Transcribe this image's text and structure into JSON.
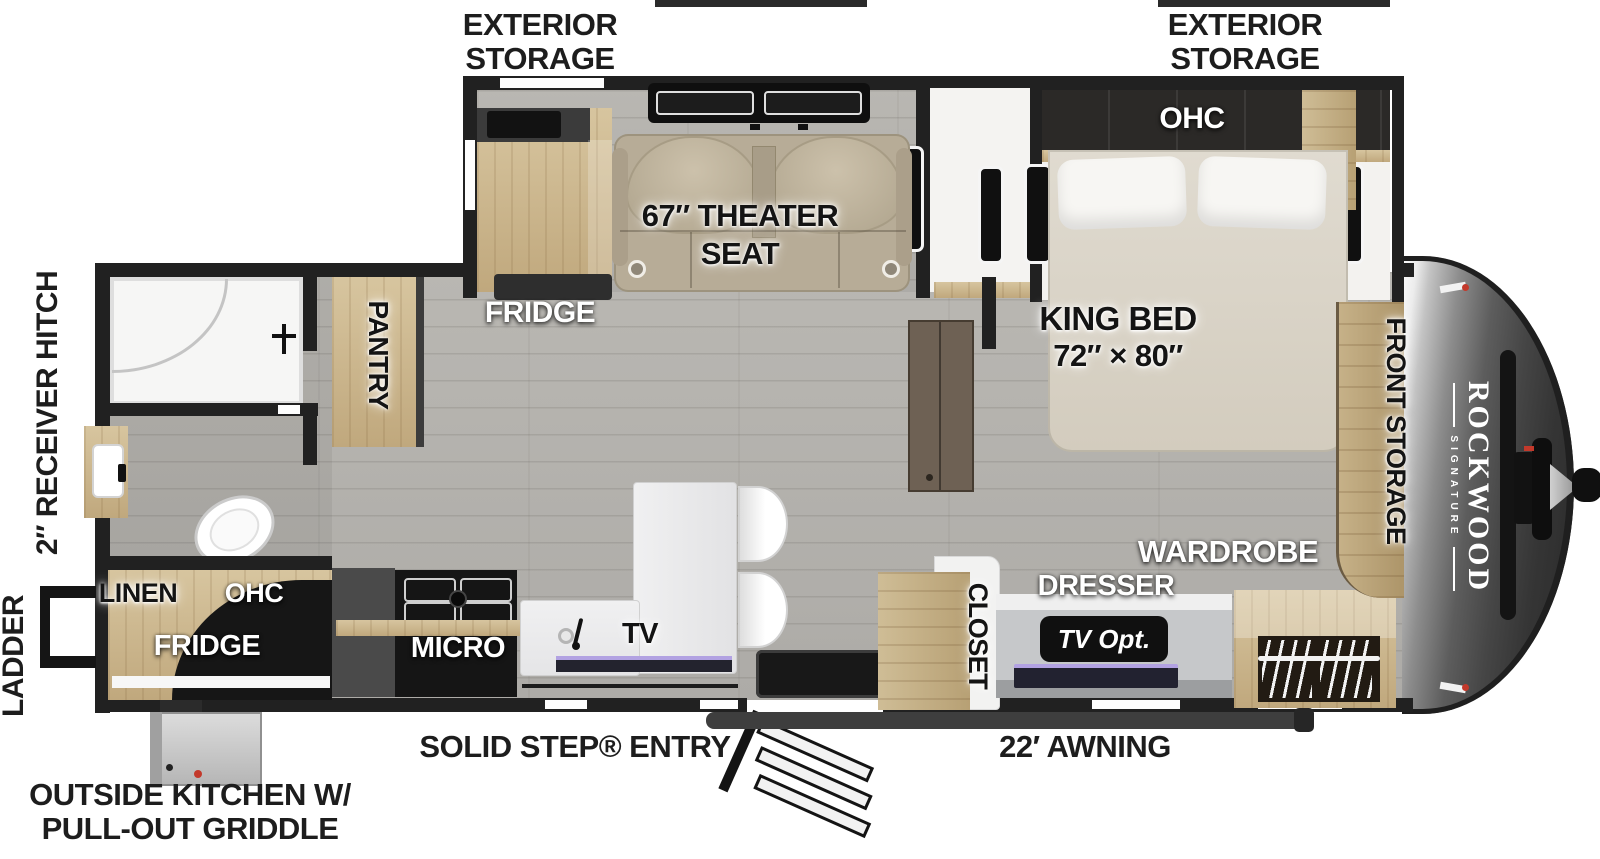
{
  "labels": {
    "exterior_storage_line1": "EXTERIOR",
    "exterior_storage_line2": "STORAGE",
    "receiver_hitch": "2″ RECEIVER HITCH",
    "ladder": "LADDER",
    "outside_kitchen_line1": "OUTSIDE KITCHEN W/",
    "outside_kitchen_line2": "PULL-OUT GRIDDLE",
    "solid_step_entry": "SOLID STEP® ENTRY",
    "awning": "22′ AWNING"
  },
  "rooms": {
    "theater_seat_line1": "67″ THEATER",
    "theater_seat_line2": "SEAT",
    "fridge_slide": "FRIDGE",
    "pantry": "PANTRY",
    "ohc_bedroom": "OHC",
    "king_bed_line1": "KING BED",
    "king_bed_line2": "72″ × 80″",
    "front_storage": "FRONT STORAGE",
    "wardrobe": "WARDROBE",
    "dresser": "DRESSER",
    "tv_opt": "TV Opt.",
    "closet": "CLOSET",
    "linen": "LINEN",
    "ohc_kitchen": "OHC",
    "fridge_outside": "FRIDGE",
    "micro": "MICRO",
    "tv": "TV"
  },
  "brand": {
    "name": "ROCKWOOD",
    "series": "SIGNATURE"
  },
  "colors": {
    "wall": "#212121",
    "wood": "#c9b188",
    "floor": "#b3b1ac",
    "cap_dark": "#2e2e2e",
    "theater_seat": "#b7ac97",
    "bed": "#dad4c8",
    "screen_accent": "#b2a2e2",
    "griddle_dot_red": "#c3392b"
  }
}
